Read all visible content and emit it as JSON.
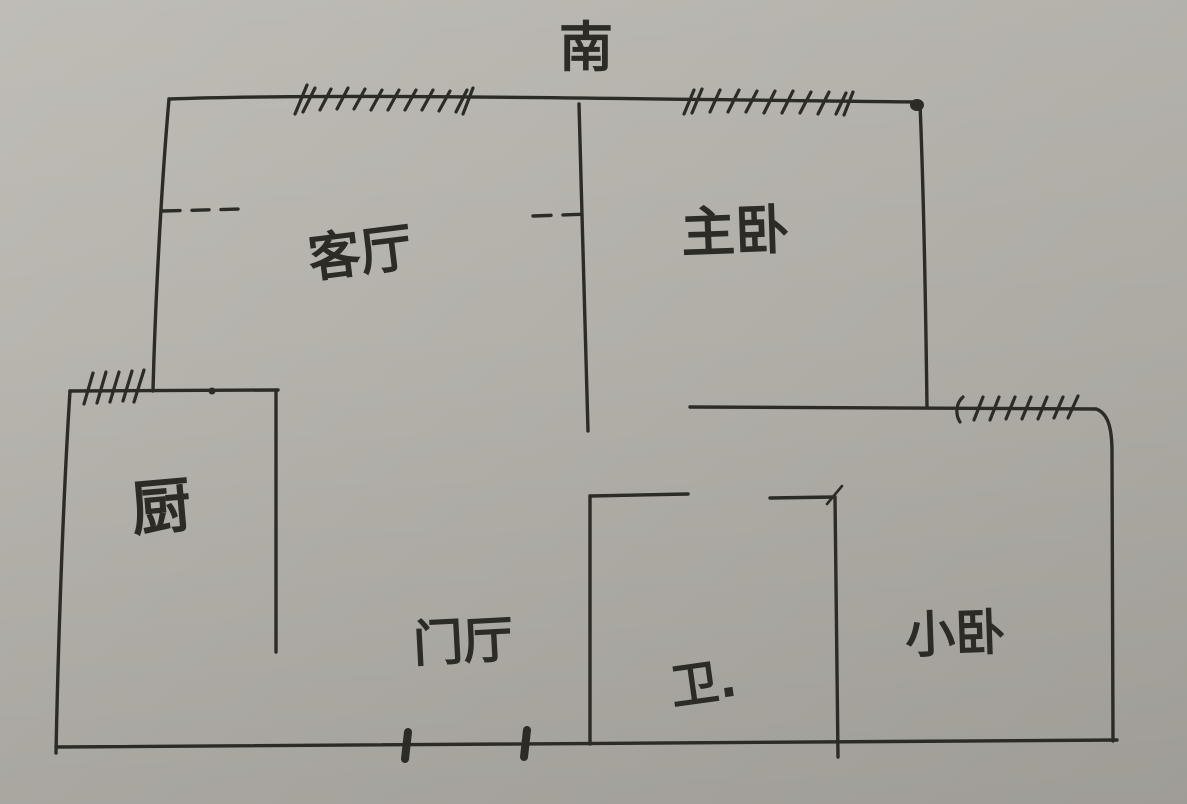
{
  "palette": {
    "paper": "#b3b0aa",
    "ink": "#2c2b26"
  },
  "compass": {
    "south_label": "南"
  },
  "rooms": {
    "living_room": {
      "label": "客厅"
    },
    "master_bedroom": {
      "label": "主卧"
    },
    "kitchen": {
      "label": "厨"
    },
    "entry_hall": {
      "label": "门厅"
    },
    "bathroom": {
      "label": "卫."
    },
    "small_bedroom": {
      "label": "小卧"
    }
  },
  "symbols": {
    "window": "hatch-marks",
    "door": "tick-marks",
    "opening": "dashed-line"
  }
}
